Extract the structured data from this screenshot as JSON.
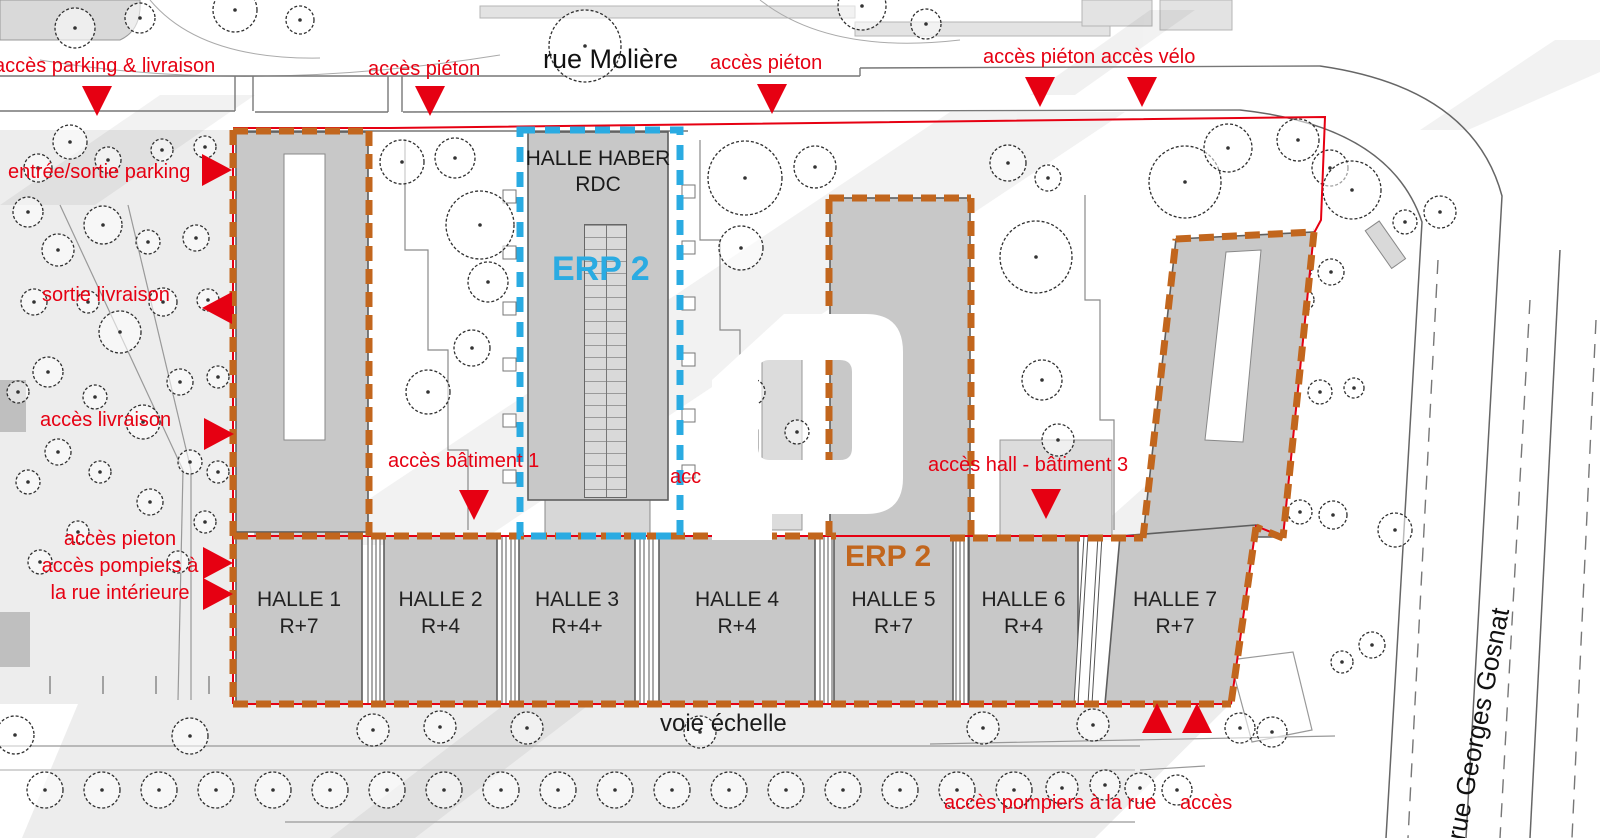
{
  "streets": {
    "top": "rue Molière",
    "right": "rue Georges Gosnat"
  },
  "zones": {
    "halle_haber_line1": "HALLE HABER",
    "halle_haber_line2": "RDC",
    "erp_blue": "ERP 2",
    "erp_orange": "ERP 2",
    "fire_lane": "voie échelle"
  },
  "halls": [
    {
      "name": "HALLE 1",
      "floors": "R+7"
    },
    {
      "name": "HALLE 2",
      "floors": "R+4"
    },
    {
      "name": "HALLE 3",
      "floors": "R+4+"
    },
    {
      "name": "HALLE 4",
      "floors": "R+4"
    },
    {
      "name": "HALLE 5",
      "floors": "R+7"
    },
    {
      "name": "HALLE 6",
      "floors": "R+4"
    },
    {
      "name": "HALLE 7",
      "floors": "R+7"
    }
  ],
  "access_labels": {
    "parking_delivery": "accès parking & livraison",
    "pedestrian_1": "accès piéton",
    "pedestrian_2": "accès piéton",
    "pedestrian_bike": "accès piéton accès vélo",
    "parking_entrance": "entrée/sortie parking",
    "delivery_exit": "sortie livraison",
    "delivery_access": "accès livraison",
    "pedestrian_firemen_line1": "accès pieton",
    "pedestrian_firemen_line2": "accès pompiers à",
    "pedestrian_firemen_line3": "la rue intérieure",
    "building1": "accès bâtiment 1",
    "building2_partial": "acc",
    "hall_building3": "accès hall - bâtiment 3",
    "firemen_street": "accès pompiers à la rue",
    "access_bottom_right": "accès"
  },
  "colors": {
    "red": "#e60012",
    "orange": "#c2661d",
    "blue": "#2aabe2",
    "building_gray": "#c8c8c8",
    "ground_gray": "#ededed"
  }
}
